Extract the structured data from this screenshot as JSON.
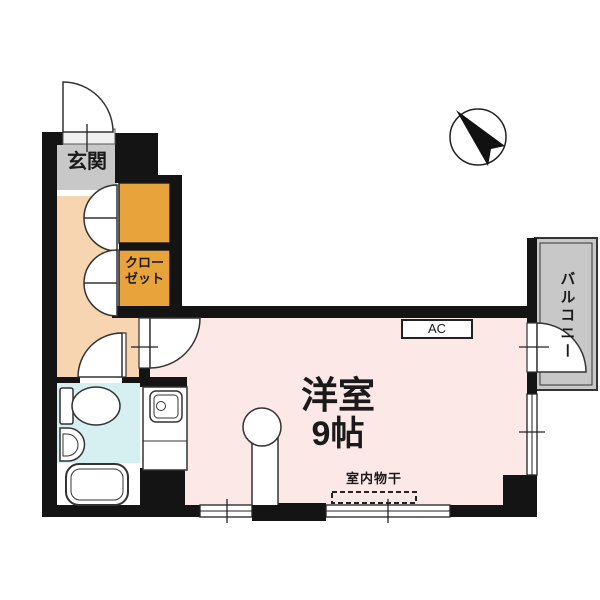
{
  "plan": {
    "entrance_label": "玄関",
    "closet_label": "クローゼット",
    "closet_lines": [
      "クロー",
      "ゼット"
    ],
    "main_room_label": "洋室",
    "main_room_size": "9帖",
    "balcony_label": "バルコニー",
    "ac_label": "AC",
    "indoor_laundry_label": "室内物干"
  },
  "colors": {
    "wall": "#141414",
    "outline": "#333333",
    "entrance_floor": "#c8c8c8",
    "hallway_floor": "#f6d5b0",
    "closet_fill": "#e8a33a",
    "bathroom_floor": "#d6f0f2",
    "main_room_floor": "#fce8e6",
    "balcony_floor": "#c8c8c8"
  }
}
